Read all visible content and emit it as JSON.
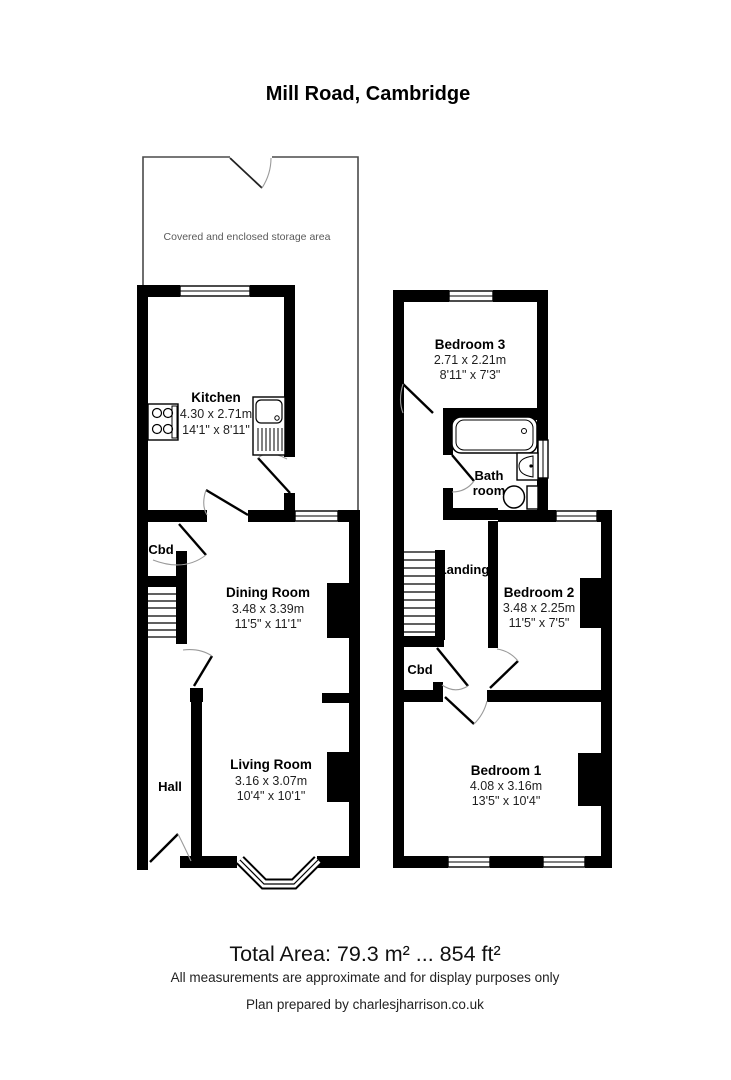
{
  "title": "Mill Road, Cambridge",
  "ground_floor": {
    "storage_label": "Covered and enclosed storage area",
    "kitchen": {
      "name": "Kitchen",
      "metric": "4.30 x 2.71m",
      "imperial": "14'1\" x 8'11\""
    },
    "cupboard": {
      "name": "Cbd"
    },
    "dining_room": {
      "name": "Dining Room",
      "metric": "3.48 x 3.39m",
      "imperial": "11'5\" x 11'1\""
    },
    "hall": {
      "name": "Hall"
    },
    "living_room": {
      "name": "Living Room",
      "metric": "3.16 x 3.07m",
      "imperial": "10'4\" x 10'1\""
    }
  },
  "first_floor": {
    "bedroom3": {
      "name": "Bedroom 3",
      "metric": "2.71 x 2.21m",
      "imperial": "8'11\" x 7'3\""
    },
    "bathroom": {
      "name_line1": "Bath",
      "name_line2": "room"
    },
    "landing": {
      "name": "Landing"
    },
    "bedroom2": {
      "name": "Bedroom 2",
      "metric": "3.48 x 2.25m",
      "imperial": "11'5\" x 7'5\""
    },
    "cupboard": {
      "name": "Cbd"
    },
    "bedroom1": {
      "name": "Bedroom 1",
      "metric": "4.08 x 3.16m",
      "imperial": "13'5\" x 10'4\""
    }
  },
  "footer": {
    "total_area": "Total Area: 79.3 m² ... 854 ft²",
    "disclaimer": "All measurements are approximate and for display purposes only",
    "credit": "Plan prepared by charlesjharrison.co.uk"
  },
  "colors": {
    "wall": "#000000",
    "background": "#ffffff",
    "storage_outline": "#4a4a4a",
    "dim_text": "#1f1f1f"
  }
}
